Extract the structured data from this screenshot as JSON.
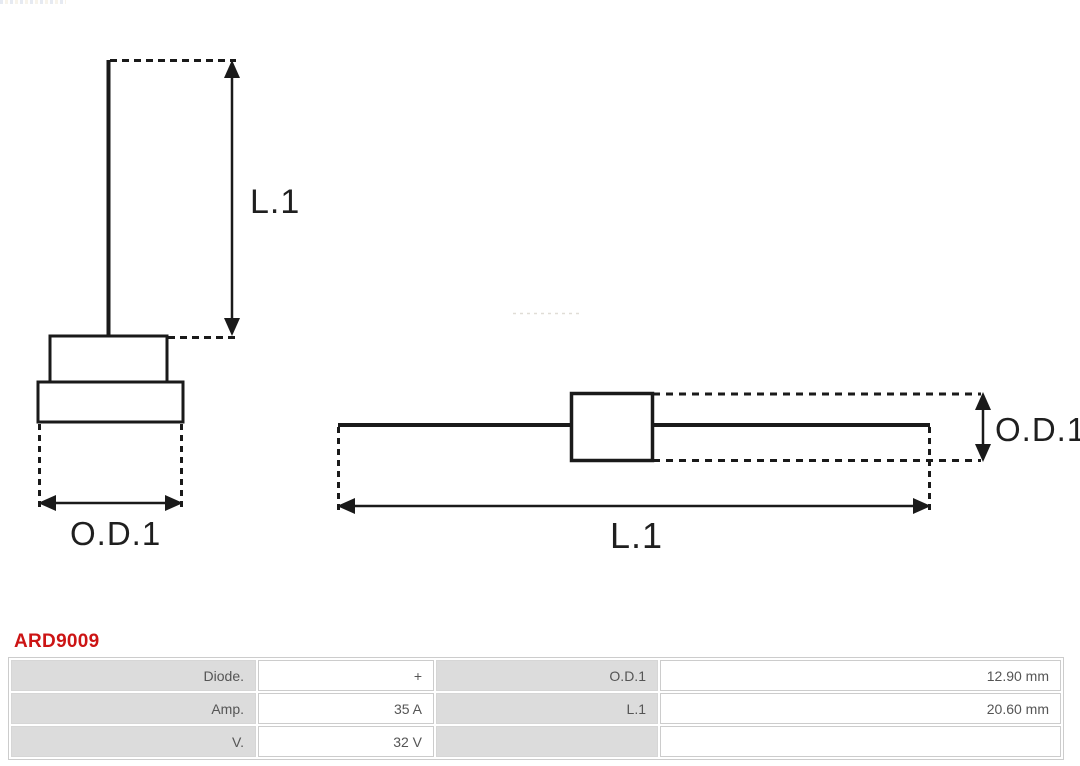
{
  "part": {
    "code": "ARD9009"
  },
  "colors": {
    "accent_red": "#cc1414",
    "drawing_line": "#1a1a1a",
    "table_label_bg": "#dcdcdc",
    "table_border": "#cccccc",
    "table_text": "#555555"
  },
  "diagram": {
    "front_view": {
      "length_label": "L.1",
      "diameter_label": "O.D.1"
    },
    "side_view": {
      "diameter_label": "O.D.1",
      "length_label": "L.1"
    }
  },
  "table": {
    "rows": [
      {
        "label1": "Diode.",
        "value1": "+",
        "label2": "O.D.1",
        "value2": "12.90 mm"
      },
      {
        "label1": "Amp.",
        "value1": "35 A",
        "label2": "L.1",
        "value2": "20.60 mm"
      },
      {
        "label1": "V.",
        "value1": "32 V",
        "label2": "",
        "value2": ""
      }
    ]
  }
}
